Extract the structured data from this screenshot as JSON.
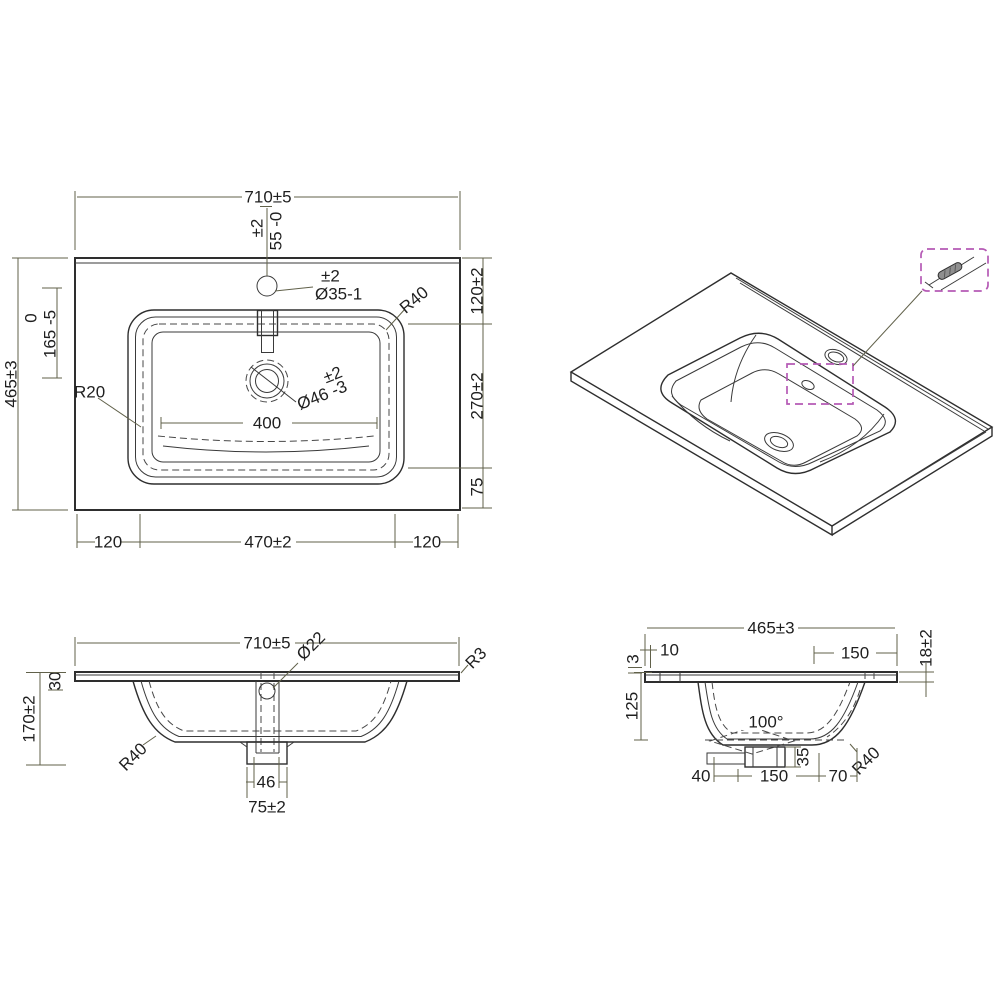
{
  "drawing": {
    "title": "basin-technical-drawing",
    "colors": {
      "object_line": "#2e2e2e",
      "dimension_line": "#61614a",
      "hidden_line": "#474747",
      "detail_callout": "#b55ab5",
      "background": "#ffffff"
    },
    "plan": {
      "width": "710±5",
      "tap_tol": "±2",
      "tap_offset": "55 -0",
      "tap_dia_tol": "±2",
      "tap_dia": "Ø35-1",
      "rim_radius": "R40",
      "right_top": "120±2",
      "right_mid": "270±2",
      "right_bot": "75",
      "depth": "465±3",
      "basin_pos_upper": "0",
      "basin_pos": "165 -5",
      "inner_radius": "R20",
      "inner_width": "400",
      "drain_dia": "Ø46 -3",
      "drain_tol": "±2",
      "bottom_left": "120",
      "bottom_mid": "470±2",
      "bottom_right": "120"
    },
    "front": {
      "width": "710±5",
      "waste_dia": "Ø22",
      "edge_radius": "R3",
      "apron": "30",
      "height": "170±2",
      "bowl_radius": "R40",
      "waste_width": "46",
      "boss_width": "75±2"
    },
    "side": {
      "depth": "465±3",
      "front_lip": "10",
      "tap_zone": "150",
      "slab_thick": "18±2",
      "lip_height": "3",
      "bowl_depth": "125",
      "cone_angle": "100°",
      "boss_height": "35",
      "bowl_radius": "R40",
      "bot_left": "40",
      "bot_mid": "150",
      "bot_right": "70"
    }
  }
}
